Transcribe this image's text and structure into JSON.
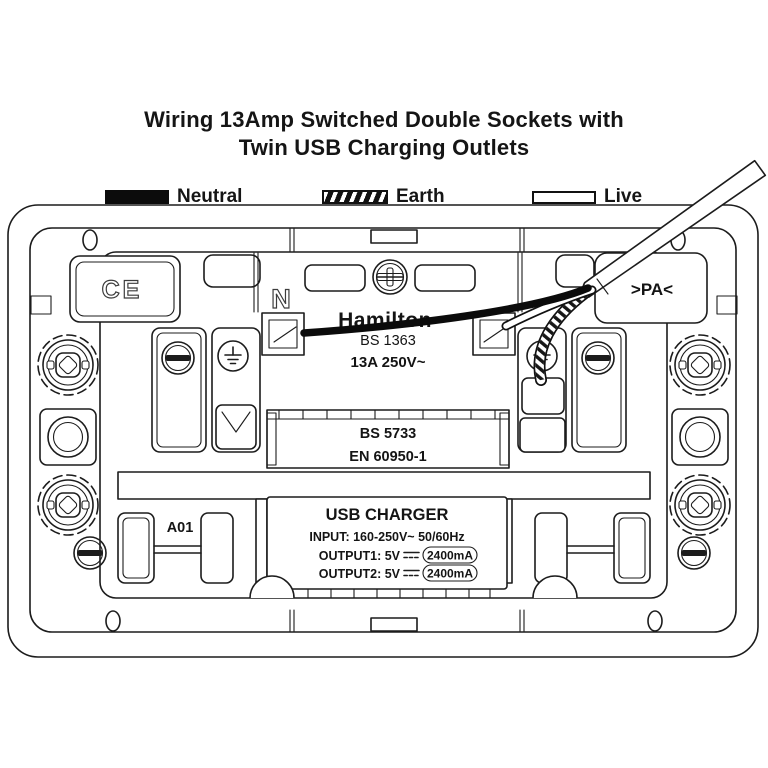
{
  "title": {
    "line1": "Wiring 13Amp Switched Double Sockets with",
    "line2": "Twin USB Charging Outlets"
  },
  "legend": {
    "items": [
      {
        "label": "Neutral",
        "swatch": "solid-black"
      },
      {
        "label": "Earth",
        "swatch": "hatched"
      },
      {
        "label": "Live",
        "swatch": "white-outline"
      }
    ]
  },
  "device": {
    "ce_mark": "CE",
    "neutral_terminal": "N",
    "pa_marking": ">PA<",
    "brand": "Hamilton",
    "plug_standard": "BS 1363",
    "rating": "13A 250V~",
    "socket_standard": "BS 5733",
    "usb_standard": "EN 60950-1",
    "module_code": "A01",
    "usb_charger": {
      "title": "USB CHARGER",
      "input": "INPUT: 160-250V~ 50/60Hz",
      "output1_label": "OUTPUT1: 5V",
      "output1_current": "2400mA",
      "output2_label": "OUTPUT2: 5V",
      "output2_current": "2400mA"
    }
  },
  "colors": {
    "line": "#1c1c1c",
    "text": "#111111",
    "background": "#ffffff"
  }
}
